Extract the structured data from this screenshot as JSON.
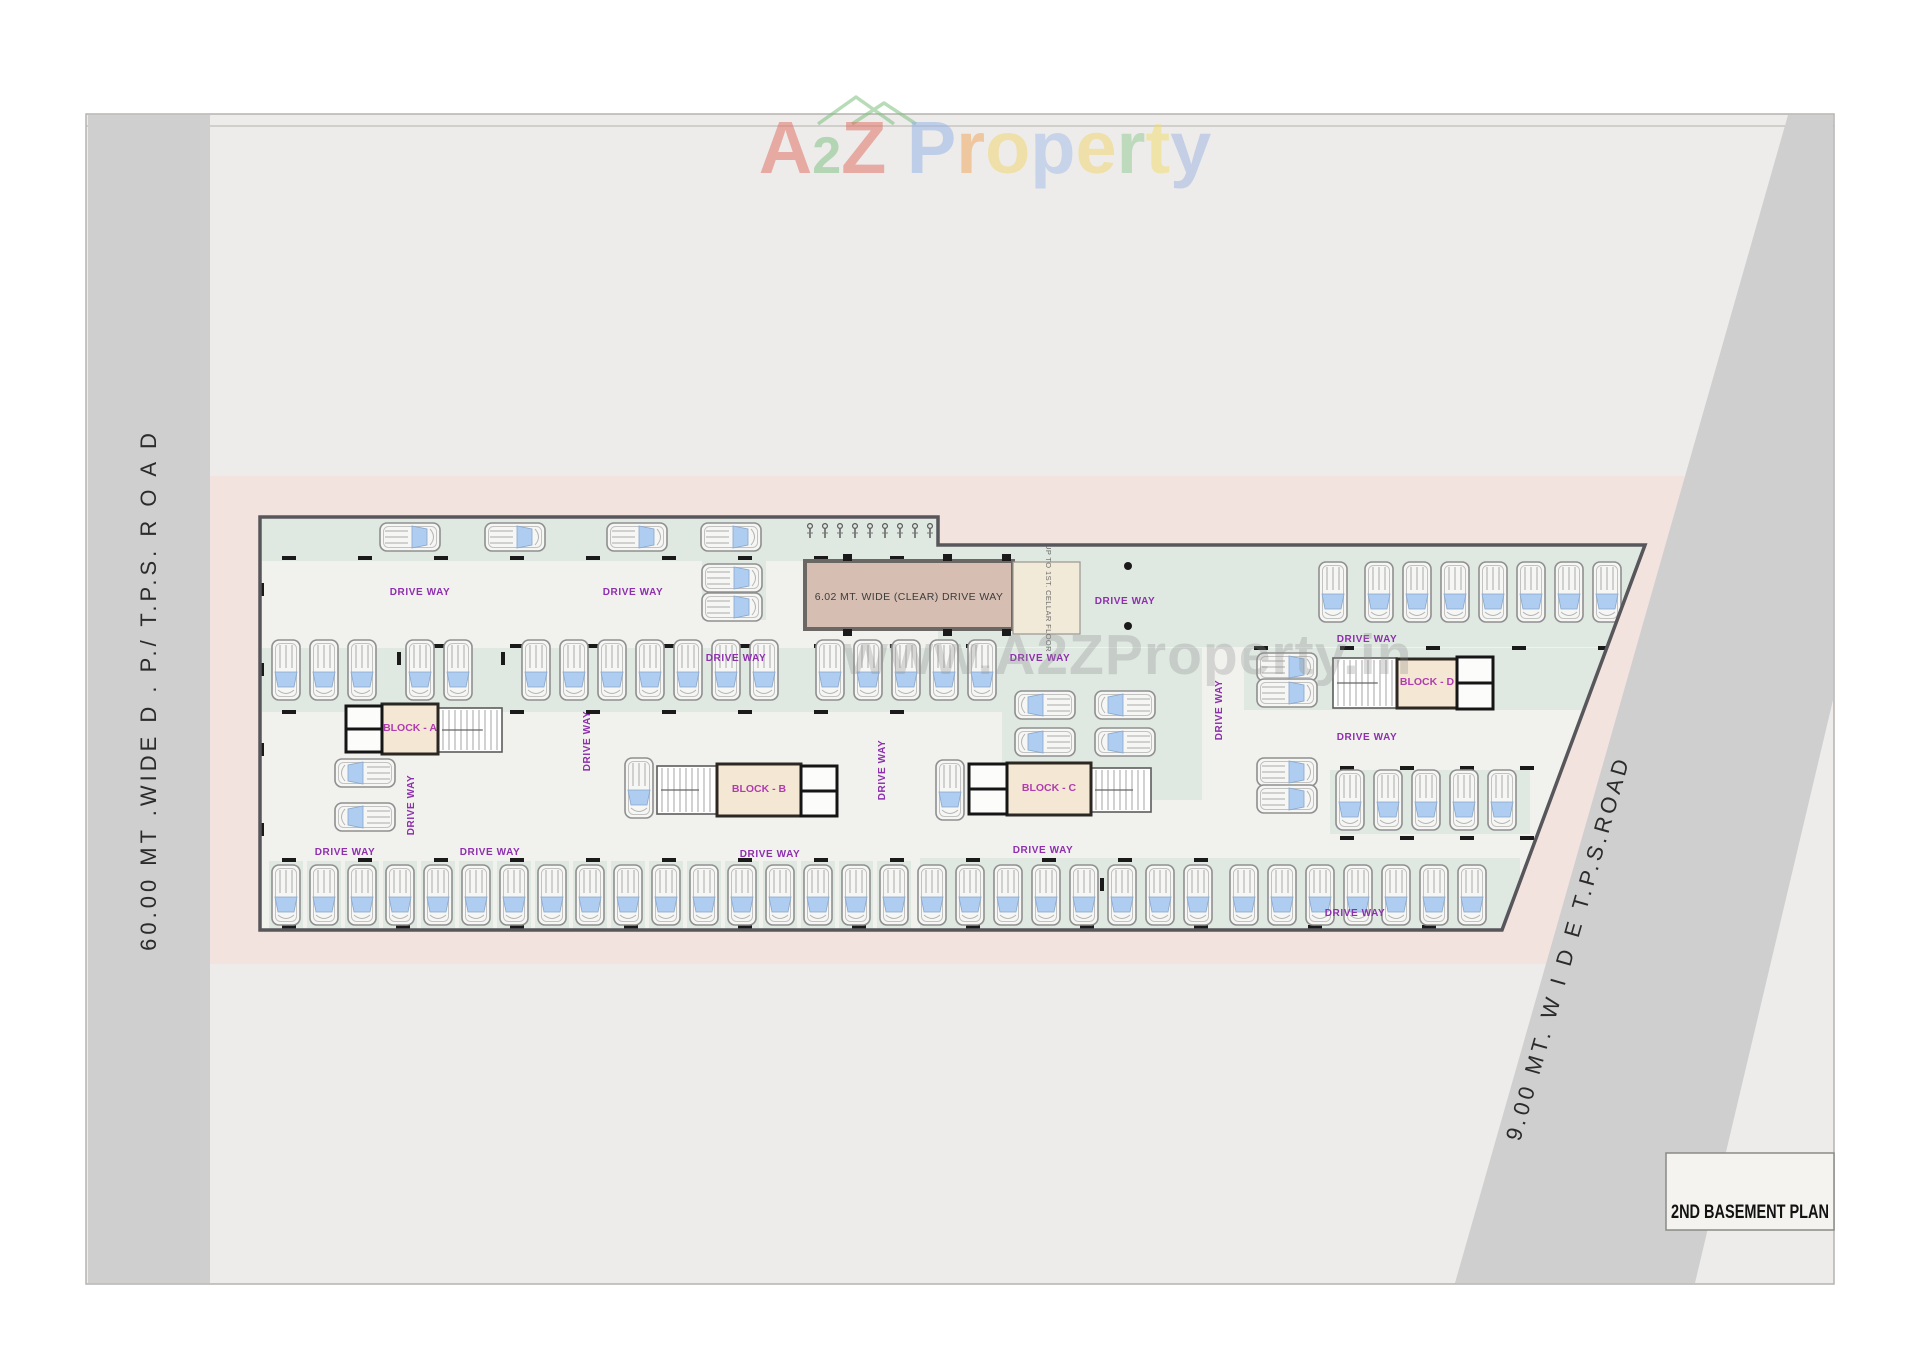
{
  "logo": {
    "word1": [
      {
        "ch": "A",
        "color": "#e06a5e"
      },
      {
        "ch": "2",
        "color": "#7cbf7c",
        "small": true
      },
      {
        "ch": "Z",
        "color": "#e06a5e"
      }
    ],
    "word2": [
      {
        "ch": "P",
        "color": "#92b2e6"
      },
      {
        "ch": "r",
        "color": "#f0a455"
      },
      {
        "ch": "o",
        "color": "#f2d468"
      },
      {
        "ch": "p",
        "color": "#a3bce8"
      },
      {
        "ch": "e",
        "color": "#f2d468"
      },
      {
        "ch": "r",
        "color": "#8fc98f"
      },
      {
        "ch": "t",
        "color": "#f2dc68"
      },
      {
        "ch": "y",
        "color": "#9cb4e2"
      }
    ],
    "house_icon_color": "#7cbf7c"
  },
  "watermark": "www.A2ZProperty.in",
  "roads": {
    "left_label": "60.00 MT .WIDE   D . P./ T.P.S. R O A D",
    "right_label": "9.00 MT. W I D E T.P.S.ROAD"
  },
  "plan": {
    "title": "2ND BASEMENT PLAN",
    "driveway_label": "DRIVE WAY",
    "ramp_label": "6.02 MT. WIDE (CLEAR) DRIVE WAY",
    "ramp_side_label": "UP TO 1ST. CELLAR FLOOR",
    "blocks": [
      {
        "name": "BLOCK - A"
      },
      {
        "name": "BLOCK - B"
      },
      {
        "name": "BLOCK - C"
      },
      {
        "name": "BLOCK - D"
      }
    ]
  },
  "colors": {
    "sheet_bg": "#edeceb",
    "road_gray": "#cfcfcf",
    "pink_band": "#f3e3df",
    "plan_floor": "#f1f2ee",
    "plan_outline": "#57565a",
    "bay_green": "#dfe8e1",
    "block_beige": "#f4e7d3",
    "block_border": "#2b2722",
    "ramp_tan": "#d6bfb2",
    "car_body": "#f6f6f4",
    "car_glass": "#aecdf0",
    "column_black": "#1a1a1a",
    "driveway_purple": "#8e2fae",
    "block_label_purple": "#b13cb1",
    "watermark_gray": "#8f8f8f"
  }
}
